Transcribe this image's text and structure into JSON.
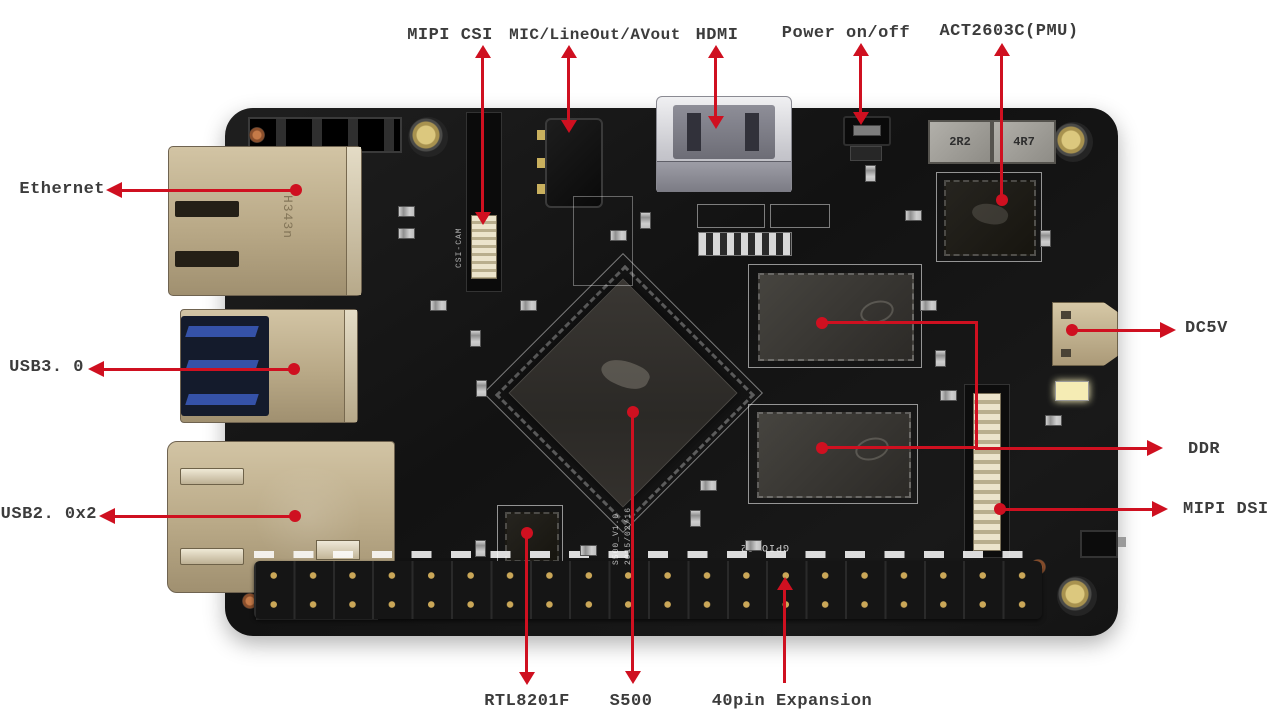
{
  "colors": {
    "arrow": "#cf1020",
    "label_text": "#3c3c3c",
    "board": "#161616",
    "connector_tan": "#bfae8e",
    "hdmi_silver": "#dcdcdf",
    "usb3_blue": "#3552a8",
    "pin_gold": "#c9a95e"
  },
  "labels": {
    "mipi_csi": "MIPI CSI",
    "mic_lineout_avout": "MIC/LineOut/AVout",
    "hdmi": "HDMI",
    "power": "Power on/off",
    "pmu": "ACT2603C(PMU)",
    "ethernet": "Ethernet",
    "usb3": "USB3. 0",
    "usb2": "USB2. 0x2",
    "dc5v": "DC5V",
    "ddr": "DDR",
    "mipi_dsi": "MIPI DSI",
    "rtl8201f": "RTL8201F",
    "s500": "S500",
    "expansion": "40pin Expansion"
  },
  "silkscreen": {
    "gpio_header": "GPIO J2",
    "ethernet_marking": "H343n",
    "inductor_1": "2R2",
    "inductor_2": "4R7",
    "csi_marking": "CSI-CAM",
    "board_rev": "S500_V1.0",
    "board_date": "2015/02/16"
  },
  "gpio": {
    "pin_columns": 20,
    "pin_rows": 2
  }
}
